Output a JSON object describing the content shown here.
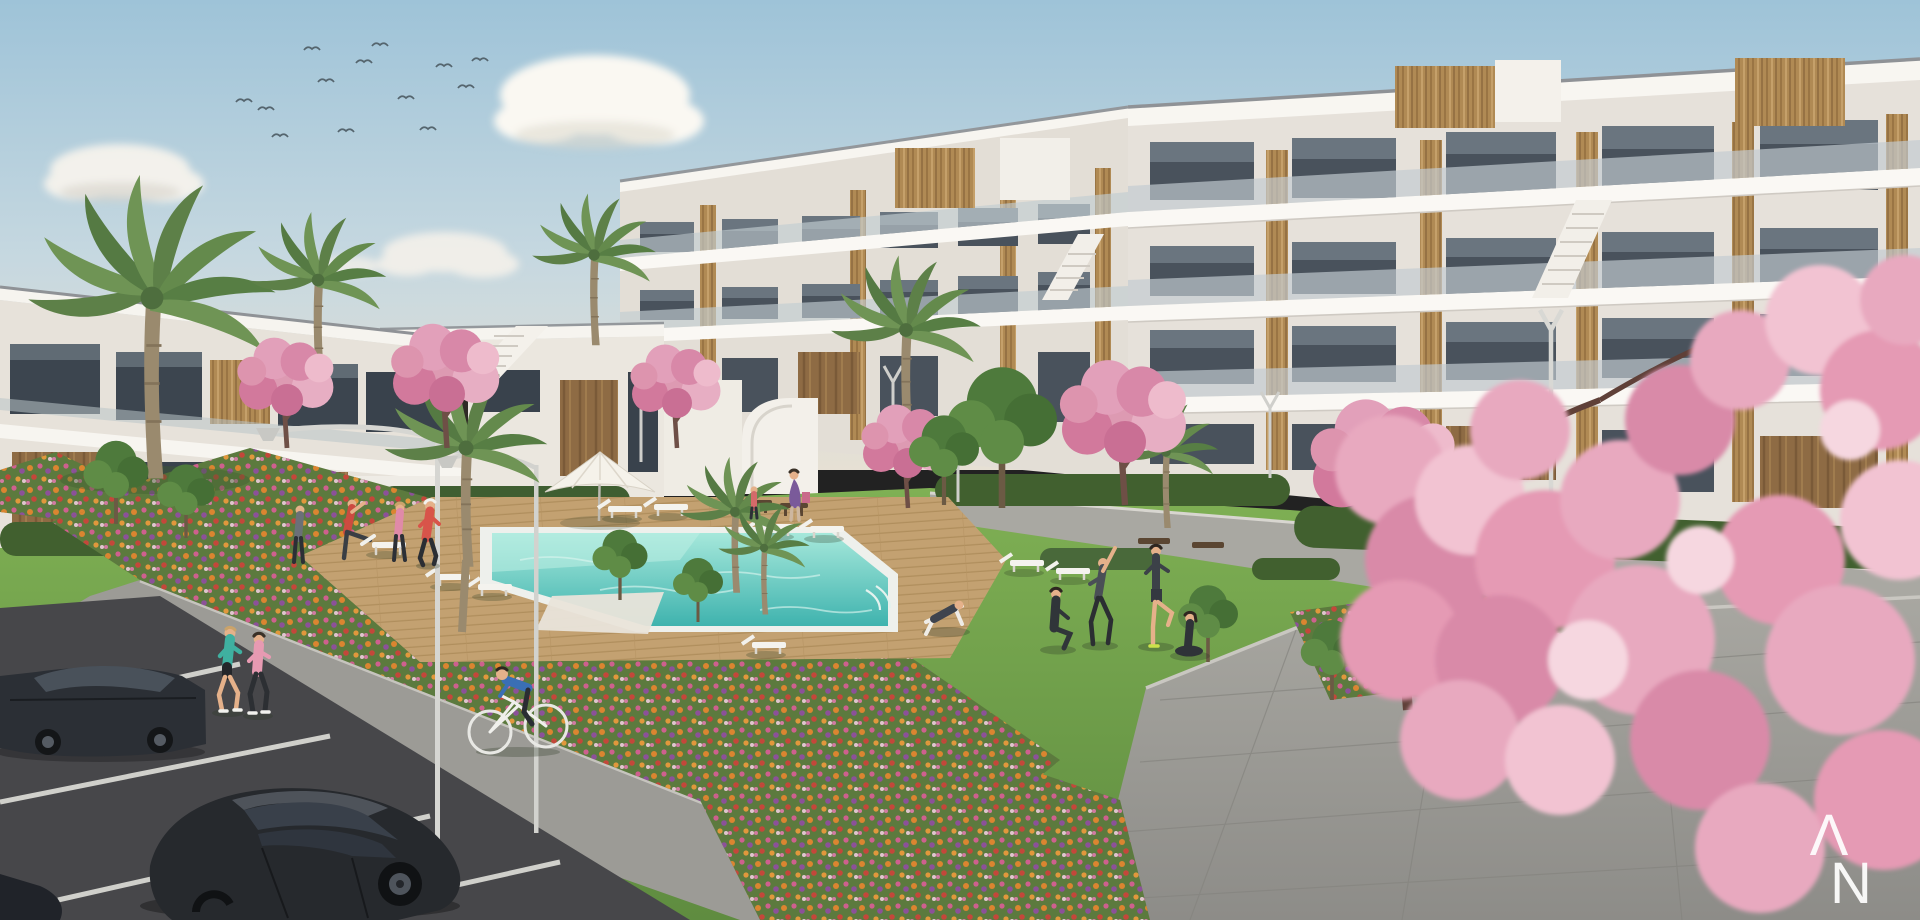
{
  "watermark": {
    "letter_top": "Λ",
    "letter_bottom": "N"
  },
  "scene": {
    "setting": "Sunny day rendering of a modern white apartment complex with communal pool gardens and parking",
    "sky": {
      "description": "Pale blue sky, soft white clouds, flock of distant birds",
      "bird_count": 13,
      "cloud_count": 4
    },
    "buildings": {
      "right_block": {
        "stories": 3,
        "style": "White modern apartments, glass balcony railings, dark glazing, vertical wood cladding",
        "rooftop": "Wood-clad stair towers on roof terraces"
      },
      "left_block": {
        "stories": 2,
        "style": "White low-rise with dark timber cladding and large windows"
      },
      "center_block": {
        "stories": 2,
        "style": "White block with timber panels and curved white external staircase"
      }
    },
    "amenities": {
      "pool": {
        "water_color": "#4cbcb4",
        "shape": "L-shaped communal pool with sun ledge",
        "deck": "wooden deck"
      },
      "umbrella_count": 1,
      "sun_lounger_count": 9,
      "bench_count": 5,
      "street_lamp_count": 7
    },
    "vegetation": {
      "palm_tree_count": 8,
      "pink_blossom_tree_count": 6,
      "flower_colors": [
        "orange",
        "pink",
        "purple",
        "red",
        "white"
      ],
      "lawn": "large green lawns with trimmed hedges"
    },
    "people": [
      {
        "label": "two women jogging on the path"
      },
      {
        "label": "man riding a white bicycle"
      },
      {
        "label": "three people warming up near pool left"
      },
      {
        "label": "woman jogging in a red top"
      },
      {
        "label": "woman with bag and child near bench"
      },
      {
        "label": "person lying on a deckchair"
      },
      {
        "label": "group stretching and doing yoga on the lawn"
      },
      {
        "label": "man and child seated on a wooden bench"
      },
      {
        "label": "two seated people and one cheering on the walkway"
      }
    ],
    "vehicles": {
      "parked_car_count": 3,
      "colors": [
        "dark grey",
        "black"
      ]
    },
    "parking": {
      "surface": "dark asphalt",
      "markings": "white stall lines"
    }
  },
  "palette": {
    "sky_top": "#9ec3d8",
    "sky_horizon": "#e6e0d4",
    "building_white": "#f5f2ec",
    "wood": "#b08a54",
    "glass": "#4a545e",
    "lawn": "#6f9e4c",
    "pool": "#56c6bd",
    "blossom": "#e3a4bb",
    "path": "#9b9a95",
    "asphalt": "#47474a"
  }
}
